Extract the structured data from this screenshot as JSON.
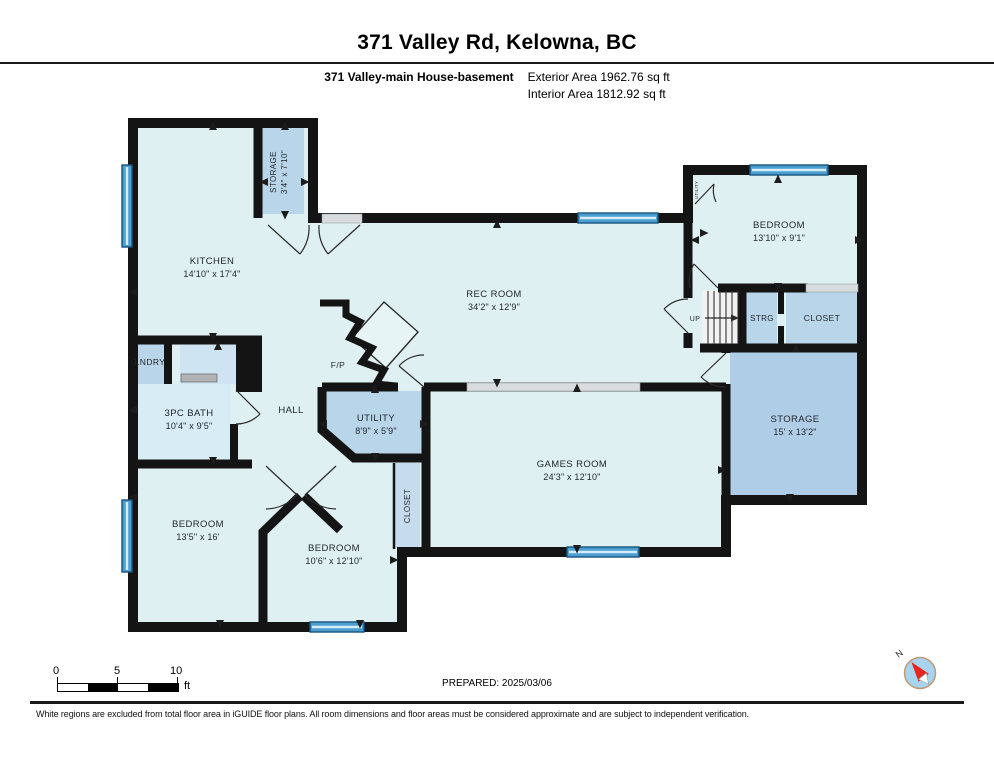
{
  "header": {
    "title": "371 Valley Rd, Kelowna, BC",
    "plan_label": "371 Valley-main House-basement",
    "exterior_area": "Exterior Area 1962.76 sq ft",
    "interior_area": "Interior Area 1812.92 sq ft"
  },
  "rooms": {
    "kitchen": {
      "name": "KITCHEN",
      "dims": "14'10\" x 17'4\""
    },
    "storage_small": {
      "name": "STORAGE",
      "dims": "3'4\" x 7'10\""
    },
    "rec_room": {
      "name": "REC ROOM",
      "dims": "34'2\" x 12'9\""
    },
    "bedroom_tr": {
      "name": "BEDROOM",
      "dims": "13'10\" x 9'1\""
    },
    "up": {
      "name": "UP"
    },
    "strg": {
      "name": "STRG"
    },
    "closet_tr": {
      "name": "CLOSET"
    },
    "storage_big": {
      "name": "STORAGE",
      "dims": "15' x 13'2\""
    },
    "games_room": {
      "name": "GAMES ROOM",
      "dims": "24'3\" x 12'10\""
    },
    "utility": {
      "name": "UTILITY",
      "dims": "8'9\" x 5'9\""
    },
    "utility_small": {
      "name": "UTILITY"
    },
    "hall": {
      "name": "HALL"
    },
    "fireplace": {
      "name": "F/P"
    },
    "laundry": {
      "name": "LNDRY"
    },
    "bath": {
      "name": "3PC BATH",
      "dims": "10'4\" x 9'5\""
    },
    "bedroom_bl": {
      "name": "BEDROOM",
      "dims": "13'5\" x 16'"
    },
    "bedroom_bm": {
      "name": "BEDROOM",
      "dims": "10'6\" x 12'10\""
    },
    "closet_b": {
      "name": "CLOSET"
    }
  },
  "scale": {
    "ticks": [
      "0",
      "5",
      "10"
    ],
    "unit": "ft"
  },
  "prepared": "PREPARED: 2025/03/06",
  "compass": {
    "north_label": "N"
  },
  "disclaimer": "White regions are excluded from total floor area in iGUIDE floor plans. All room dimensions and floor areas must be considered approximate and are subject to independent verification.",
  "colors": {
    "wall": "#141414",
    "room_light": "#dff0f2",
    "room_medium": "#b9d5e9",
    "room_medium_dark": "#b0cde7",
    "room_bath": "#d8ecf6",
    "room_alcove": "#cfe4f2",
    "closet_strip": "#c6dcee",
    "window": "#4b9fd0",
    "compass_red": "#e8251f",
    "compass_fill": "#a8d4f0"
  }
}
